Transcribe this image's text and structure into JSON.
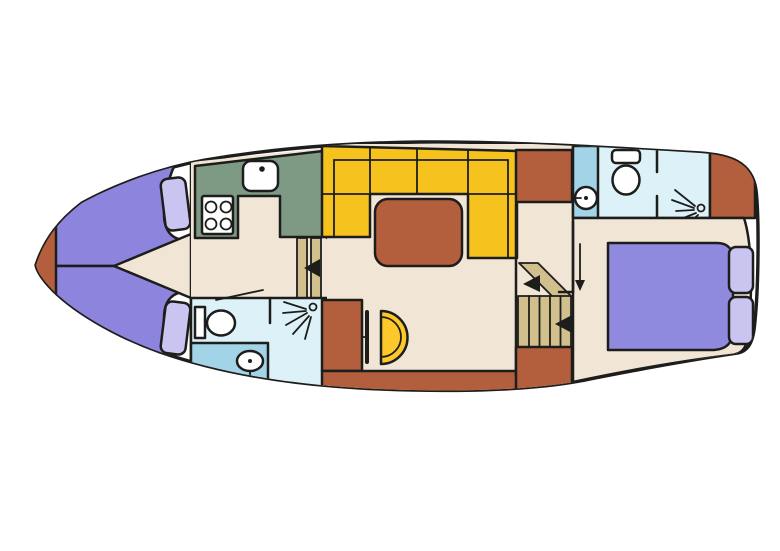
{
  "figure": {
    "type": "boat-floor-plan",
    "rooms": [
      {
        "name": "bow-anchor-locker"
      },
      {
        "name": "v-berth-cabin"
      },
      {
        "name": "galley"
      },
      {
        "name": "forward-bathroom"
      },
      {
        "name": "salon"
      },
      {
        "name": "companionway-stairs"
      },
      {
        "name": "aft-bathroom"
      },
      {
        "name": "aft-cabin"
      }
    ],
    "fixtures": [
      {
        "name": "galley-sink"
      },
      {
        "name": "stove-4-burner",
        "burners": 4
      },
      {
        "name": "forward-toilet"
      },
      {
        "name": "forward-washbasin"
      },
      {
        "name": "forward-shower-head"
      },
      {
        "name": "l-shaped-sofa"
      },
      {
        "name": "salon-table"
      },
      {
        "name": "half-round-folding-table"
      },
      {
        "name": "aft-toilet"
      },
      {
        "name": "aft-washbasin"
      },
      {
        "name": "aft-shower-head"
      },
      {
        "name": "double-bed",
        "pillows": 2
      },
      {
        "name": "v-berths",
        "pillows": 2
      }
    ]
  },
  "colors": {
    "background": "#ffffff",
    "outline": "#1d1d1b",
    "hull_white": "#ffffff",
    "floor_beige": "#f1e5d6",
    "terracotta": "#b35f3d",
    "berth_purple": "#8d85dd",
    "pillow_purple": "#cac5f0",
    "bed_purple": "#8f8ade",
    "sofa_yellow": "#f6c21d",
    "half_table_yellow": "#fdc829",
    "galley_green": "#7e9a85",
    "bath_light_blue": "#dcf2f8",
    "bath_medium_blue": "#a2d3e6",
    "stair_khaki": "#d1bf8e",
    "fixture_white": "#ffffff"
  }
}
